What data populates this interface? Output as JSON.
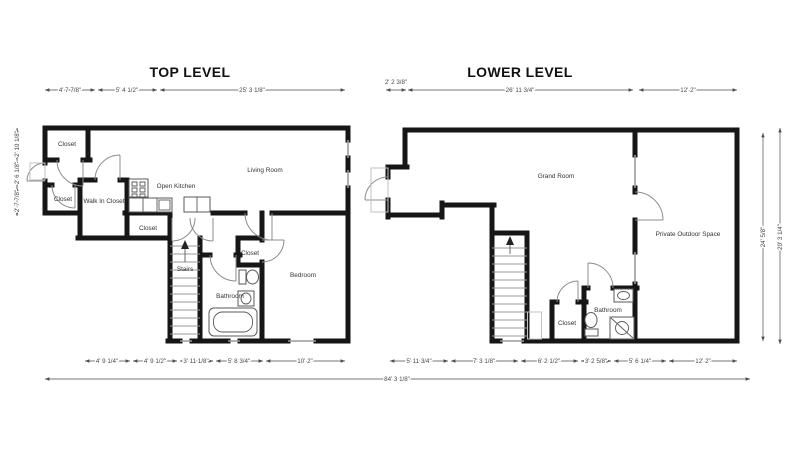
{
  "top_level": {
    "title": "TOP LEVEL",
    "rooms": {
      "closet_entry": "Closet",
      "closet_left": "Closet",
      "walk_in_closet": "Walk In Closet",
      "open_kitchen": "Open Kitchen",
      "living_room": "Living Room",
      "closet_hall": "Closet",
      "stairs": "Stairs",
      "closet_bedroom": "Closet",
      "bathroom": "Bathroom",
      "bedroom": "Bedroom"
    },
    "dims_top": [
      "4' 7 7/8\"",
      "5' 4 1/2\"",
      "25' 3 1/8\""
    ],
    "dims_bottom": [
      "4' 9 1/4\"",
      "4' 9 1/2\"",
      "3' 11 1/8\"",
      "5' 8 3/4\"",
      "10' 2\""
    ],
    "dims_left": [
      "2' 10 1/8\"",
      "2' 6 1/8\"",
      "2' 7 7/8\""
    ]
  },
  "lower_level": {
    "title": "LOWER LEVEL",
    "rooms": {
      "grand_room": "Grand Room",
      "closet": "Closet",
      "bathroom": "Bathroom",
      "private_outdoor_space": "Private Outdoor Space"
    },
    "dims_top": [
      "2' 2 3/8\"",
      "26' 11 3/4\"",
      "12' 2\""
    ],
    "dims_bottom": [
      "5' 11 3/4\"",
      "7' 3 1/8\"",
      "6' 2 1/2\"",
      "3' 2 5/8\"",
      "5' 6 1/4\"",
      "12' 2\""
    ],
    "dims_right": [
      "24' 5/8\"",
      "20' 3 1/4\""
    ]
  },
  "overall": {
    "width": "84' 3 1/8\""
  },
  "colors": {
    "wall": "#161616",
    "dim_text": "#474747",
    "window": "#9a9a9a",
    "background": "#ffffff"
  }
}
